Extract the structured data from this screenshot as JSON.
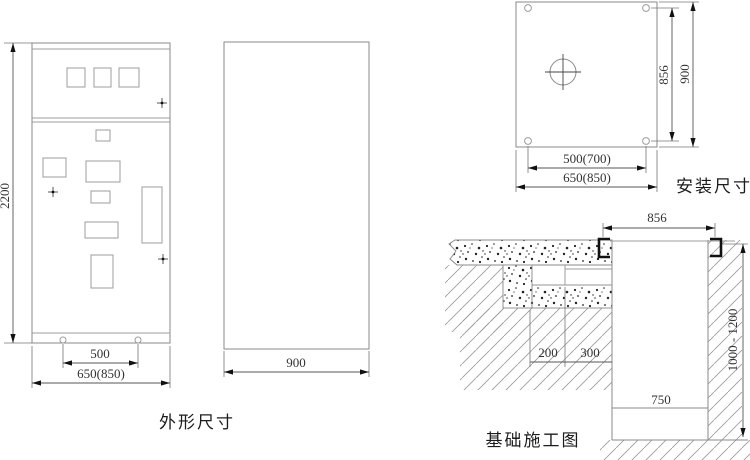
{
  "views": {
    "front": {
      "label": "外形尺寸",
      "dim_height": "2200",
      "dim_hole_span": "500",
      "dim_width": "650(850)"
    },
    "side": {
      "dim_depth": "900"
    },
    "install": {
      "label": "安装尺寸",
      "dim_hole_vspan": "856",
      "dim_height": "900",
      "dim_hole_hspan": "500(700)",
      "dim_width": "650(850)"
    },
    "foundation": {
      "label": "基础施工图",
      "dim_channel_span": "856",
      "dim_duct_width": "200",
      "dim_ledge_width": "300",
      "dim_pit_depth": "1000 - 1200",
      "dim_pit_width": "750"
    }
  },
  "colors": {
    "background": "#ffffff",
    "outline": "#8a8a8a",
    "dimension_line": "#555555",
    "arrow": "#111111",
    "text": "#333333",
    "caption": "#1c1c1c",
    "hatch": "#9a9a9a",
    "stipple": "#222222"
  }
}
